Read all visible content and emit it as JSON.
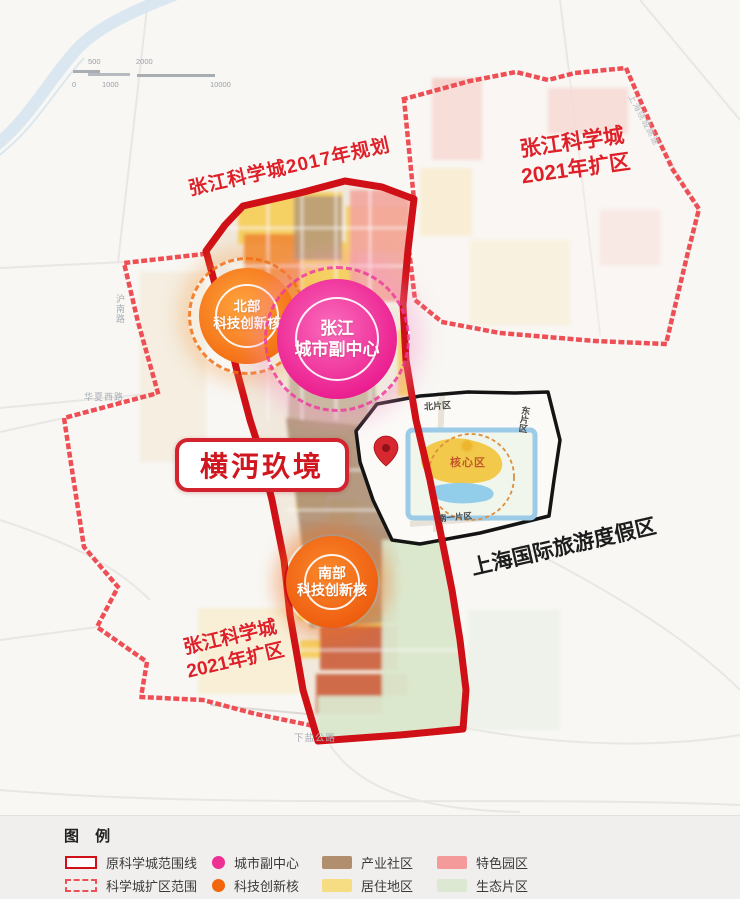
{
  "map": {
    "scalebar": {
      "top": [
        "500",
        "2000"
      ],
      "bottom": [
        "0",
        "1000",
        "10000"
      ]
    },
    "boundary_labels": {
      "plan2017": "张江科学城2017年规划",
      "expand_ne_line1": "张江科学城",
      "expand_ne_line2": "2021年扩区",
      "expand_sw_line1": "张江科学城",
      "expand_sw_line2": "2021年扩区"
    },
    "cores": {
      "north": {
        "line1": "北部",
        "line2": "科技创新核",
        "color": "#f2660d"
      },
      "subcenter": {
        "line1": "张江",
        "line2": "城市副中心",
        "color": "#ee2f93"
      },
      "south": {
        "line1": "南部",
        "line2": "科技创新核",
        "color": "#f2660d"
      }
    },
    "project_label": "横沔玖境",
    "resort": {
      "name": "上海国际旅游度假区",
      "north_district": "北片区",
      "east_district": "东片区",
      "south_district": "南一片区",
      "core_district": "核心区"
    },
    "roads": {
      "hunan": "沪南路",
      "huaxia": "华夏西路",
      "xiayan": "下盐公路",
      "raocheng": "上海绕城高速"
    }
  },
  "legend": {
    "title": "图 例",
    "items": [
      {
        "label": "原科学城范围线",
        "swatch": "outline",
        "color": "#cf1016"
      },
      {
        "label": "科学城扩区范围",
        "swatch": "dashed",
        "color": "#ee4f55"
      },
      {
        "label": "城市副中心",
        "swatch": "dot",
        "color": "#ee2f93"
      },
      {
        "label": "科技创新核",
        "swatch": "dot",
        "color": "#f2660d"
      },
      {
        "label": "产业社区",
        "swatch": "rect",
        "color": "#b08e6e"
      },
      {
        "label": "居住地区",
        "swatch": "rect",
        "color": "#f6dd84"
      },
      {
        "label": "特色园区",
        "swatch": "rect",
        "color": "#f49a9b"
      },
      {
        "label": "生态片区",
        "swatch": "rect",
        "color": "#dce8d2"
      }
    ]
  }
}
